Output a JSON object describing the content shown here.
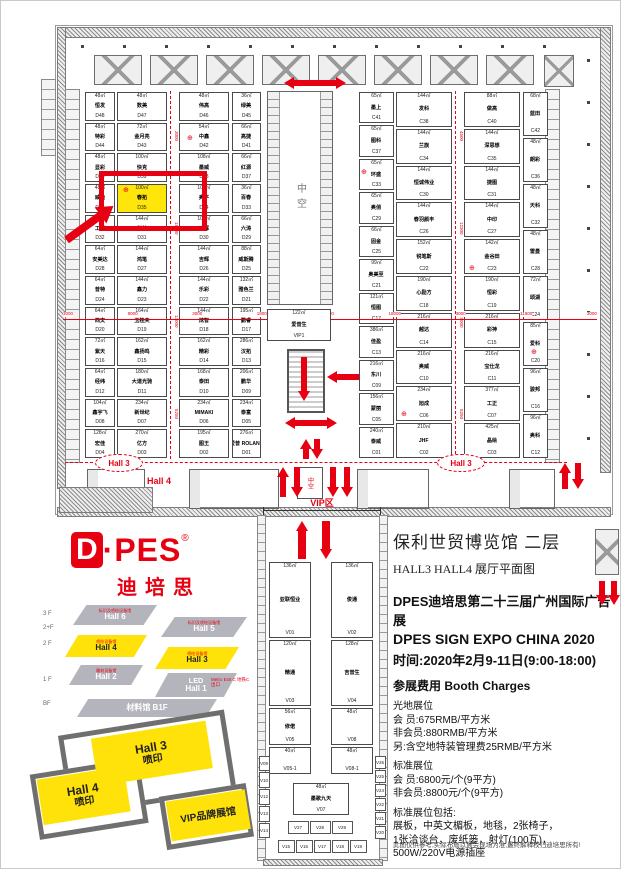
{
  "colors": {
    "accent_red": "#e60012",
    "highlight_yellow": "#ffe60a",
    "wall_gray": "#9a9a9a"
  },
  "symbols": {
    "hydrant": "⊕"
  },
  "plan": {
    "atrium_label": "中空",
    "small_void_label": "中空",
    "hall4_label": "Hall 4",
    "hall3_left": "Hall 3",
    "hall3_right": "Hall 3",
    "vip1_booth": {
      "size": "122㎡",
      "name": "爱普生",
      "id": "VIP1"
    },
    "dim_numbers": [
      {
        "v": "3000"
      },
      {
        "v": "8000"
      },
      {
        "v": "3000"
      },
      {
        "v": "18000"
      },
      {
        "v": "3000"
      },
      {
        "v": "18000"
      },
      {
        "v": "3000"
      },
      {
        "v": "11800"
      },
      {
        "v": "3000"
      }
    ],
    "aisle1_numbers": [
      {
        "v": "3000"
      },
      {
        "v": "18000"
      },
      {
        "v": "13000"
      },
      {
        "v": "5250"
      }
    ],
    "aisle2_numbers": [
      {
        "v": "4500"
      },
      {
        "v": "12300"
      },
      {
        "v": "18000"
      },
      {
        "v": "5250"
      }
    ],
    "d_block": {
      "col1": [
        {
          "size": "48㎡",
          "name": "恒发",
          "id": "D48"
        },
        {
          "size": "48㎡",
          "name": "特彩",
          "id": "D44"
        },
        {
          "size": "48㎡",
          "name": "显彩",
          "id": "D40"
        },
        {
          "size": "48㎡",
          "name": "威迪",
          "id": "D36"
        },
        {
          "size": "48㎡",
          "name": "工程",
          "id": "D32"
        },
        {
          "size": "64㎡",
          "name": "安美达",
          "id": "D28"
        },
        {
          "size": "64㎡",
          "name": "普特",
          "id": "D24"
        },
        {
          "size": "64㎡",
          "name": "西文",
          "id": "D20"
        },
        {
          "size": "72㎡",
          "name": "紫天",
          "id": "D16"
        },
        {
          "size": "64㎡",
          "name": "经纬",
          "id": "D12"
        },
        {
          "size": "104㎡",
          "name": "鑫宇飞",
          "id": "D08"
        },
        {
          "size": "128㎡",
          "name": "宏佳",
          "id": "D04"
        }
      ],
      "col2": [
        {
          "size": "48㎡",
          "name": "数美",
          "id": "D47"
        },
        {
          "size": "72㎡",
          "name": "金月亮",
          "id": "D43"
        },
        {
          "size": "100㎡",
          "name": "快克",
          "id": "D39"
        },
        {
          "size": "100㎡",
          "name": "春拓",
          "id": "D35",
          "cls": "highlight"
        },
        {
          "size": "144㎡",
          "name": "科美",
          "id": "D31"
        },
        {
          "size": "144㎡",
          "name": "鸿笔",
          "id": "D27"
        },
        {
          "size": "144㎡",
          "name": "鑫力",
          "id": "D23"
        },
        {
          "size": "164㎡",
          "name": "玉桂夫",
          "id": "D19"
        },
        {
          "size": "162㎡",
          "name": "鑫扬鸣",
          "id": "D15"
        },
        {
          "size": "180㎡",
          "name": "大道光驰",
          "id": "D11"
        },
        {
          "size": "234㎡",
          "name": "新世纪",
          "id": "D07"
        },
        {
          "size": "270㎡",
          "name": "亿方",
          "id": "D03"
        }
      ],
      "col3": [
        {
          "size": "48㎡",
          "name": "伟高",
          "id": "D46"
        },
        {
          "size": "54㎡",
          "name": "中鑫",
          "id": "D42"
        },
        {
          "size": "108㎡",
          "name": "墨威",
          "id": "D38"
        },
        {
          "size": "108㎡",
          "name": "奥平",
          "id": "D34"
        },
        {
          "size": "108㎡",
          "name": "迪辉",
          "id": "D30"
        },
        {
          "size": "144㎡",
          "name": "吉辉",
          "id": "D26"
        },
        {
          "size": "144㎡",
          "name": "乐彩",
          "id": "D22"
        },
        {
          "size": "144㎡",
          "name": "炫智",
          "id": "D18"
        },
        {
          "size": "162㎡",
          "name": "精彩",
          "id": "D14"
        },
        {
          "size": "168㎡",
          "name": "泰田",
          "id": "D10"
        },
        {
          "size": "234㎡",
          "name": "MIMAKI",
          "id": "D06"
        },
        {
          "size": "195㎡",
          "name": "图王",
          "id": "D02"
        }
      ],
      "col4": [
        {
          "size": "36㎡",
          "name": "绿美",
          "id": "D45"
        },
        {
          "size": "66㎡",
          "name": "高捷",
          "id": "D41"
        },
        {
          "size": "66㎡",
          "name": "红源",
          "id": "D37"
        },
        {
          "size": "36㎡",
          "name": "百春",
          "id": "D33"
        },
        {
          "size": "66㎡",
          "name": "六涛",
          "id": "D29"
        },
        {
          "size": "88㎡",
          "name": "威斯腾",
          "id": "D25"
        },
        {
          "size": "132㎡",
          "name": "雅色兰",
          "id": "D21"
        },
        {
          "size": "195㎡",
          "name": "鹏睿",
          "id": "D17"
        },
        {
          "size": "286㎡",
          "name": "汉拓",
          "id": "D13"
        },
        {
          "size": "206㎡",
          "name": "鹏华",
          "id": "D09"
        },
        {
          "size": "234㎡",
          "name": "泰富",
          "id": "D05"
        },
        {
          "size": "276㎡",
          "name": "爱普 ROLAND",
          "id": "D01"
        }
      ]
    },
    "c_block": {
      "col1": [
        {
          "size": "65㎡",
          "name": "墨上",
          "id": "C41"
        },
        {
          "size": "65㎡",
          "name": "图科",
          "id": "C37"
        },
        {
          "size": "65㎡",
          "name": "环盛",
          "id": "C33"
        },
        {
          "size": "65㎡",
          "name": "奥俏",
          "id": "C29"
        },
        {
          "size": "66㎡",
          "name": "固金",
          "id": "C25"
        },
        {
          "size": "99㎡",
          "name": "奥美至",
          "id": "C21"
        },
        {
          "size": "121㎡",
          "name": "恒图",
          "id": "C17"
        },
        {
          "size": "386㎡",
          "name": "佳盈",
          "id": "C13"
        },
        {
          "size": "216㎡",
          "name": "东川",
          "id": "C09"
        },
        {
          "size": "156㎡",
          "name": "蒙丽",
          "id": "C05"
        },
        {
          "size": "240㎡",
          "name": "泰威",
          "id": "C01"
        }
      ],
      "col2": [
        {
          "size": "144㎡",
          "name": "发科",
          "id": "C38"
        },
        {
          "size": "144㎡",
          "name": "兰旗",
          "id": "C34"
        },
        {
          "size": "144㎡",
          "name": "恒诚伟业",
          "id": "C30"
        },
        {
          "size": "144㎡",
          "name": "春羽颜丰",
          "id": "C26"
        },
        {
          "size": "152㎡",
          "name": "锐笔斯",
          "id": "C22"
        },
        {
          "size": "190㎡",
          "name": "心励方",
          "id": "C18"
        },
        {
          "size": "216㎡",
          "name": "越达",
          "id": "C14"
        },
        {
          "size": "216㎡",
          "name": "奥威",
          "id": "C10"
        },
        {
          "size": "234㎡",
          "name": "旭成",
          "id": "C06"
        },
        {
          "size": "210㎡",
          "name": "JHF",
          "id": "C02"
        }
      ],
      "col3": [
        {
          "size": "88㎡",
          "name": "做高",
          "id": "C40"
        },
        {
          "size": "144㎡",
          "name": "深思想",
          "id": "C35"
        },
        {
          "size": "144㎡",
          "name": "捷图",
          "id": "C31"
        },
        {
          "size": "144㎡",
          "name": "中印",
          "id": "C27"
        },
        {
          "size": "142㎡",
          "name": "金谷田",
          "id": "C23"
        },
        {
          "size": "190㎡",
          "name": "恒彩",
          "id": "C19"
        },
        {
          "size": "216㎡",
          "name": "彩神",
          "id": "C15"
        },
        {
          "size": "216㎡",
          "name": "宝仕龙",
          "id": "C11"
        },
        {
          "size": "377㎡",
          "name": "工正",
          "id": "C07"
        },
        {
          "size": "425㎡",
          "name": "晶绘",
          "id": "C03"
        }
      ],
      "col4": [
        {
          "size": "68㎡",
          "name": "蓝田",
          "id": "C42"
        },
        {
          "size": "48㎡",
          "name": "朗彩",
          "id": "C36"
        },
        {
          "size": "48㎡",
          "name": "天科",
          "id": "C32"
        },
        {
          "size": "48㎡",
          "name": "雷曼",
          "id": "C28"
        },
        {
          "size": "72㎡",
          "name": "颂湖",
          "id": "C24"
        },
        {
          "size": "85㎡",
          "name": "爱科",
          "id": "C20"
        },
        {
          "size": "96㎡",
          "name": "骏邦",
          "id": "C16"
        },
        {
          "size": "96㎡",
          "name": "奥科",
          "id": "C12"
        }
      ]
    }
  },
  "vip_corridor": {
    "label": "VIP区",
    "left": [
      {
        "size": "136㎡",
        "name": "亚联恒业",
        "id": "V01",
        "cls": "v-tall"
      },
      {
        "size": "120㎡",
        "name": "精通",
        "id": "V03",
        "cls": "v-med"
      },
      {
        "size": "56㎡",
        "name": "修偌",
        "id": "V05",
        "cls": "v-s"
      },
      {
        "size": "40㎡",
        "name": "",
        "id": "V05-1",
        "cls": "v-xs"
      }
    ],
    "right": [
      {
        "size": "136㎡",
        "name": "俊通",
        "id": "V02",
        "cls": "v-tall"
      },
      {
        "size": "128㎡",
        "name": "吉普生",
        "id": "V04",
        "cls": "v-med"
      },
      {
        "size": "48㎡",
        "name": "",
        "id": "V08",
        "cls": "v-s"
      },
      {
        "size": "48㎡",
        "name": "",
        "id": "V08-1",
        "cls": "v-xs"
      }
    ],
    "center": [
      {
        "size": "48㎡",
        "name": "墨歌九天",
        "id": "V07"
      }
    ],
    "left_small": [
      {
        "id": "V09"
      },
      {
        "id": "V10"
      },
      {
        "id": "V12"
      },
      {
        "id": "V13"
      },
      {
        "id": "V14"
      }
    ],
    "right_small": [
      {
        "id": "V26"
      },
      {
        "id": "V25"
      },
      {
        "id": "V24"
      },
      {
        "id": "V22"
      },
      {
        "id": "V21"
      },
      {
        "id": "V20"
      }
    ],
    "bottom_row1": [
      {
        "id": "V27"
      },
      {
        "id": "V28"
      },
      {
        "id": "V29"
      }
    ],
    "bottom_row2": [
      {
        "id": "V15"
      },
      {
        "id": "V16"
      },
      {
        "id": "V17"
      },
      {
        "id": "V18"
      },
      {
        "id": "V19"
      }
    ]
  },
  "branding": {
    "logo_d": "D",
    "logo_rest": "·PES",
    "logo_reg": "®",
    "logo_cn": "迪培思"
  },
  "stack_diagram": {
    "floor_labels": [
      {
        "label": "3 F",
        "cls": "fl-0"
      },
      {
        "label": "2+F",
        "cls": "fl-1"
      },
      {
        "label": "2 F",
        "cls": "fl-2"
      },
      {
        "label": "1 F",
        "cls": "fl-3"
      },
      {
        "label": "BF",
        "cls": "fl-4"
      }
    ],
    "halls": [
      {
        "tag": "标识及喷绘设备馆",
        "name": "Hall 6",
        "cls": "gray hall6"
      },
      {
        "tag": "标识及喷绘设备馆",
        "name": "Hall 5",
        "cls": "gray hall5"
      },
      {
        "tag": "喷绘设备馆",
        "name": "Hall 4",
        "cls": "yellow hall4"
      },
      {
        "tag": "喷绘设备馆",
        "name": "Hall 3",
        "cls": "yellow hall3"
      },
      {
        "tag": "雕刻设备馆",
        "name": "Hall 2",
        "cls": "gray hall2"
      },
      {
        "tag": "LED",
        "name": "Hall 1",
        "cls": "gray hall1"
      },
      {
        "tag": "",
        "name": "材料馆  B1F",
        "cls": "gray hallb1"
      }
    ],
    "metro": "Metro Exit C 地铁C出口"
  },
  "minimap": {
    "hall3": "Hall 3",
    "hall3_sub": "喷印",
    "hall4": "Hall 4",
    "hall4_sub": "喷印",
    "vip": "VIP品牌展馆"
  },
  "info": {
    "venue": "保利世贸博览馆  二层",
    "subtitle": "HALL3 HALL4  展厅平面图",
    "expo_cn": "DPES迪培思第二十三届广州国际广告展",
    "expo_en": "DPES SIGN EXPO CHINA 2020",
    "time": "时间:2020年2月9-11日(9:00-18:00)",
    "charges_title": "参展费用  Booth Charges",
    "raw_title": "光地展位",
    "raw_lines": [
      {
        "t": "会  员:675RMB/平方米"
      },
      {
        "t": "非会员:880RMB/平方米"
      },
      {
        "t": "另:含空地特装管理费25RMB/平方米"
      }
    ],
    "std_title": "标准展位",
    "std_lines": [
      {
        "t": "会  员:6800元/个(9平方)"
      },
      {
        "t": "非会员:8800元/个(9平方)"
      }
    ],
    "incl_title": "标准展位包括:",
    "incl_lines": [
      {
        "t": "展板，中英文楣板，地毯，2张椅子，"
      },
      {
        "t": "1张洽谈台，废纸篓，射灯(100瓦)，"
      },
      {
        "t": "500W/220V电源插座"
      }
    ],
    "contact_line1": "联系电话： 020-38200584",
    "contact_line2": "13924196993 潘小姐",
    "disclaimer": "此图仅供参考,实际布局以展会现场为准,最终解释权归迪培思所有!"
  }
}
